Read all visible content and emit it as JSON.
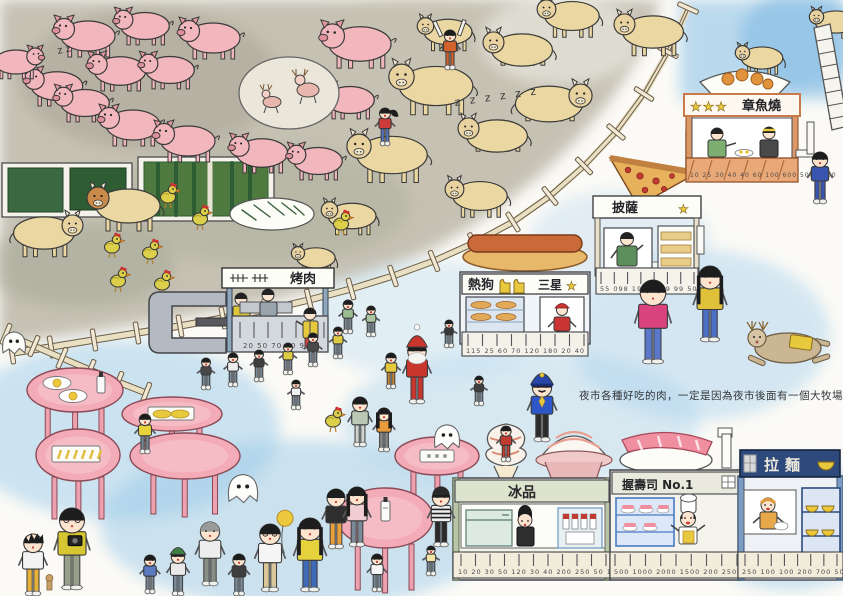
{
  "artwork": {
    "caption": "夜市各種好吃的肉，一定是因為夜市後面有一個大牧場，",
    "sleep_marks": {
      "pigs": "z z",
      "cows": "z z z  z z z"
    },
    "stalls": {
      "bbq": {
        "name": "烤肉",
        "prices": "20 50 70 90 90"
      },
      "hotdog": {
        "name": "熱狗",
        "rating": "三星",
        "star": "★",
        "prices": "115 25 60 70 120 180 20 40"
      },
      "pizza": {
        "name": "披薩",
        "star": "★",
        "prices": "55 098 199 1599 99 50"
      },
      "takoyaki": {
        "name": "章魚燒",
        "stars": "★★★",
        "prices": "10 25 30 40 40 60 100 600 500 1000"
      },
      "ice": {
        "name": "冰品",
        "prices": "10 20 30 50 120 30 40 200 250 50 110 115"
      },
      "sushi": {
        "name": "握壽司 No.1",
        "prices": "500 1000 2000 1500 200 250 300 700"
      },
      "ramen": {
        "name": "拉麵",
        "prices": "250 100 100 200 700 500 350 250"
      }
    },
    "palette": {
      "pig_pink": "#f2b7bc",
      "cow_tan": "#ead7a2",
      "chicken_yellow": "#dcd04a",
      "table_pink": "#f3abb7",
      "farm_wash": "#b3ae9d",
      "market_blue": "#a5d0ec",
      "takoyaki_orange": "#e0956a",
      "ramen_navy": "#2e4a7d",
      "star_yellow": "#e8c93e"
    },
    "scene": {
      "pigs": [
        [
          88,
          36,
          1.0,
          -1
        ],
        [
          145,
          26,
          0.9,
          -1
        ],
        [
          213,
          38,
          1.0,
          -1
        ],
        [
          120,
          71,
          0.95,
          -1
        ],
        [
          57,
          86,
          0.95,
          -1
        ],
        [
          170,
          70,
          0.9,
          -1
        ],
        [
          85,
          103,
          0.9,
          -1
        ],
        [
          133,
          125,
          1.0,
          -1
        ],
        [
          188,
          141,
          1.0,
          -1
        ],
        [
          262,
          153,
          0.95,
          -1
        ],
        [
          318,
          161,
          0.9,
          -1
        ],
        [
          350,
          100,
          0.9,
          -1
        ],
        [
          16,
          62,
          0.8,
          1
        ],
        [
          360,
          44,
          1.15,
          -1
        ]
      ],
      "cows": [
        [
          448,
          32,
          0.75,
          -1,
          0
        ],
        [
          522,
          50,
          0.95,
          -1,
          1
        ],
        [
          572,
          16,
          0.85,
          -1,
          0
        ],
        [
          653,
          32,
          0.95,
          -1,
          0
        ],
        [
          762,
          58,
          0.65,
          -1,
          0
        ],
        [
          836,
          22,
          0.65,
          -1,
          0
        ],
        [
          436,
          86,
          1.15,
          -1,
          0
        ],
        [
          549,
          104,
          1.05,
          1,
          1
        ],
        [
          497,
          136,
          0.95,
          -1,
          1
        ],
        [
          392,
          155,
          1.1,
          -1,
          0
        ],
        [
          128,
          206,
          1.0,
          -1,
          0,
          "#c98a4a"
        ],
        [
          44,
          233,
          0.95,
          1,
          0
        ],
        [
          352,
          216,
          0.75,
          -1,
          0
        ],
        [
          316,
          258,
          0.6,
          -1,
          0
        ],
        [
          480,
          196,
          0.85,
          -1,
          0
        ]
      ],
      "chickens": [
        [
          168,
          197
        ],
        [
          200,
          219
        ],
        [
          112,
          247
        ],
        [
          150,
          253
        ],
        [
          118,
          281
        ],
        [
          162,
          284
        ],
        [
          341,
          224
        ],
        [
          333,
          421
        ]
      ],
      "ghosts": [
        [
          14,
          344,
          11
        ],
        [
          243,
          490,
          14
        ],
        [
          447,
          438,
          12
        ]
      ],
      "tables": [
        {
          "x": 75,
          "y": 390,
          "rx": 48,
          "ry": 22,
          "food": "eggs"
        },
        {
          "x": 78,
          "y": 455,
          "rx": 42,
          "ry": 26,
          "food": "fries"
        },
        {
          "x": 172,
          "y": 414,
          "rx": 50,
          "ry": 17,
          "food": "corn"
        },
        {
          "x": 185,
          "y": 456,
          "rx": 55,
          "ry": 23,
          "food": "none"
        },
        {
          "x": 437,
          "y": 456,
          "rx": 42,
          "ry": 19,
          "food": "tray"
        },
        {
          "x": 385,
          "y": 518,
          "rx": 48,
          "ry": 30,
          "food": "bottle"
        }
      ],
      "people": [
        {
          "x": 450,
          "y": 66,
          "h": 36,
          "shirt": "#d4622c",
          "pants": "#d4622c",
          "v": "sticks"
        },
        {
          "x": 385,
          "y": 142,
          "h": 34,
          "shirt": "#cc3a3a",
          "pants": "#5577cc",
          "v": "ponytail"
        },
        {
          "x": 348,
          "y": 330,
          "h": 30,
          "shirt": "#9bbd92"
        },
        {
          "x": 371,
          "y": 333,
          "h": 27,
          "shirt": "#aac7a2"
        },
        {
          "x": 360,
          "y": 443,
          "h": 46,
          "shirt": "#b9c9b4",
          "pants": "#cfd4cc"
        },
        {
          "x": 384,
          "y": 448,
          "h": 40,
          "shirt": "#e89a3c",
          "pants": "#888888",
          "v": "longhair"
        },
        {
          "x": 206,
          "y": 386,
          "h": 28,
          "shirt": "#474747"
        },
        {
          "x": 233,
          "y": 383,
          "h": 30,
          "shirt": "#ededed"
        },
        {
          "x": 259,
          "y": 378,
          "h": 28,
          "shirt": "#3e3e3e"
        },
        {
          "x": 288,
          "y": 371,
          "h": 28,
          "shirt": "#ddcb45"
        },
        {
          "x": 313,
          "y": 363,
          "h": 30,
          "shirt": "#4a4a4a"
        },
        {
          "x": 338,
          "y": 355,
          "h": 28,
          "shirt": "#ddcb45"
        },
        {
          "x": 391,
          "y": 385,
          "h": 32,
          "shirt": "#e6c83d",
          "pants": "#cc8833"
        },
        {
          "x": 417,
          "y": 400,
          "h": 58,
          "shirt": "#c8362e",
          "pants": "#c8362e",
          "v": "santa"
        },
        {
          "x": 449,
          "y": 344,
          "h": 24,
          "shirt": "#383838"
        },
        {
          "x": 542,
          "y": 438,
          "h": 60,
          "shirt": "#2d57c8",
          "pants": "#2b2b2b",
          "v": "police"
        },
        {
          "x": 653,
          "y": 360,
          "h": 80,
          "shirt": "#d8437d",
          "pants": "#5a77c9"
        },
        {
          "x": 710,
          "y": 338,
          "h": 72,
          "shirt": "#dfc23a",
          "pants": "#4a6fc4",
          "v": "longhair"
        },
        {
          "x": 820,
          "y": 200,
          "h": 48,
          "shirt": "#3a55b0",
          "pants": "#3a55b0"
        },
        {
          "x": 145,
          "y": 450,
          "h": 36,
          "shirt": "#e8d23c"
        },
        {
          "x": 296,
          "y": 406,
          "h": 26,
          "shirt": "#f0f0f0"
        },
        {
          "x": 479,
          "y": 402,
          "h": 26,
          "shirt": "#3f3f3f"
        },
        {
          "x": 506,
          "y": 458,
          "h": 32,
          "shirt": "#c23b30",
          "pants": "#c23b30"
        },
        {
          "x": 33,
          "y": 592,
          "h": 58,
          "shirt": "#f3f3f3",
          "pants": "#e6b23c",
          "v": "spiky"
        },
        {
          "x": 72,
          "y": 586,
          "h": 78,
          "shirt": "#d6c631",
          "pants": "#98a08a",
          "v": "camera"
        },
        {
          "x": 150,
          "y": 590,
          "h": 35,
          "shirt": "#5b79c0"
        },
        {
          "x": 178,
          "y": 592,
          "h": 42,
          "shirt": "#e9e9e9",
          "v": "capgreen"
        },
        {
          "x": 210,
          "y": 582,
          "h": 60,
          "shirt": "#ededed",
          "pants": "#8a8f85",
          "hair": "#9a9a9a"
        },
        {
          "x": 239,
          "y": 592,
          "h": 38,
          "shirt": "#3d3d3d"
        },
        {
          "x": 270,
          "y": 588,
          "h": 64,
          "shirt": "#f5f5f5",
          "pants": "#d9c79a",
          "v": "balloon"
        },
        {
          "x": 310,
          "y": 588,
          "h": 70,
          "shirt": "#e6d23c",
          "pants": "#3f6ab5",
          "v": "longhair"
        },
        {
          "x": 336,
          "y": 545,
          "h": 56,
          "shirt": "#2e2e2e",
          "pants": "#e8a03c"
        },
        {
          "x": 357,
          "y": 543,
          "h": 56,
          "shirt": "#f0cdd2",
          "v": "longhair"
        },
        {
          "x": 441,
          "y": 543,
          "h": 54,
          "shirt": "#f0f0f0",
          "pants": "#2a2a2a",
          "v": "prisoner"
        },
        {
          "x": 377,
          "y": 588,
          "h": 34,
          "shirt": "#f5f5f5"
        },
        {
          "x": 431,
          "y": 572,
          "h": 26,
          "shirt": "#f2e5a8"
        }
      ],
      "fence_main": [
        [
          688,
          8
        ],
        [
          668,
          52
        ],
        [
          644,
          94
        ],
        [
          616,
          132
        ],
        [
          584,
          166
        ],
        [
          550,
          196
        ],
        [
          513,
          222
        ],
        [
          474,
          243
        ],
        [
          434,
          261
        ],
        [
          393,
          276
        ],
        [
          351,
          289
        ],
        [
          309,
          300
        ],
        [
          266,
          310
        ],
        [
          223,
          318
        ],
        [
          180,
          326
        ],
        [
          137,
          333
        ],
        [
          94,
          340
        ],
        [
          51,
          347
        ],
        [
          12,
          353
        ]
      ],
      "fence_corner": [
        [
          6,
          334
        ],
        [
          34,
          346
        ],
        [
          62,
          358
        ],
        [
          90,
          370
        ],
        [
          118,
          382
        ],
        [
          146,
          393
        ]
      ],
      "ticks": [
        {
          "x1": 240,
          "x2": 324,
          "y": 322,
          "h": 16,
          "n": 7
        },
        {
          "x1": 468,
          "x2": 584,
          "y": 334,
          "h": 12,
          "n": 9
        },
        {
          "x1": 601,
          "x2": 694,
          "y": 272,
          "h": 12,
          "n": 8
        },
        {
          "x1": 461,
          "x2": 606,
          "y": 554,
          "h": 12,
          "n": 11
        },
        {
          "x1": 615,
          "x2": 737,
          "y": 554,
          "h": 12,
          "n": 9
        },
        {
          "x1": 745,
          "x2": 837,
          "y": 554,
          "h": 12,
          "n": 8
        }
      ]
    }
  }
}
